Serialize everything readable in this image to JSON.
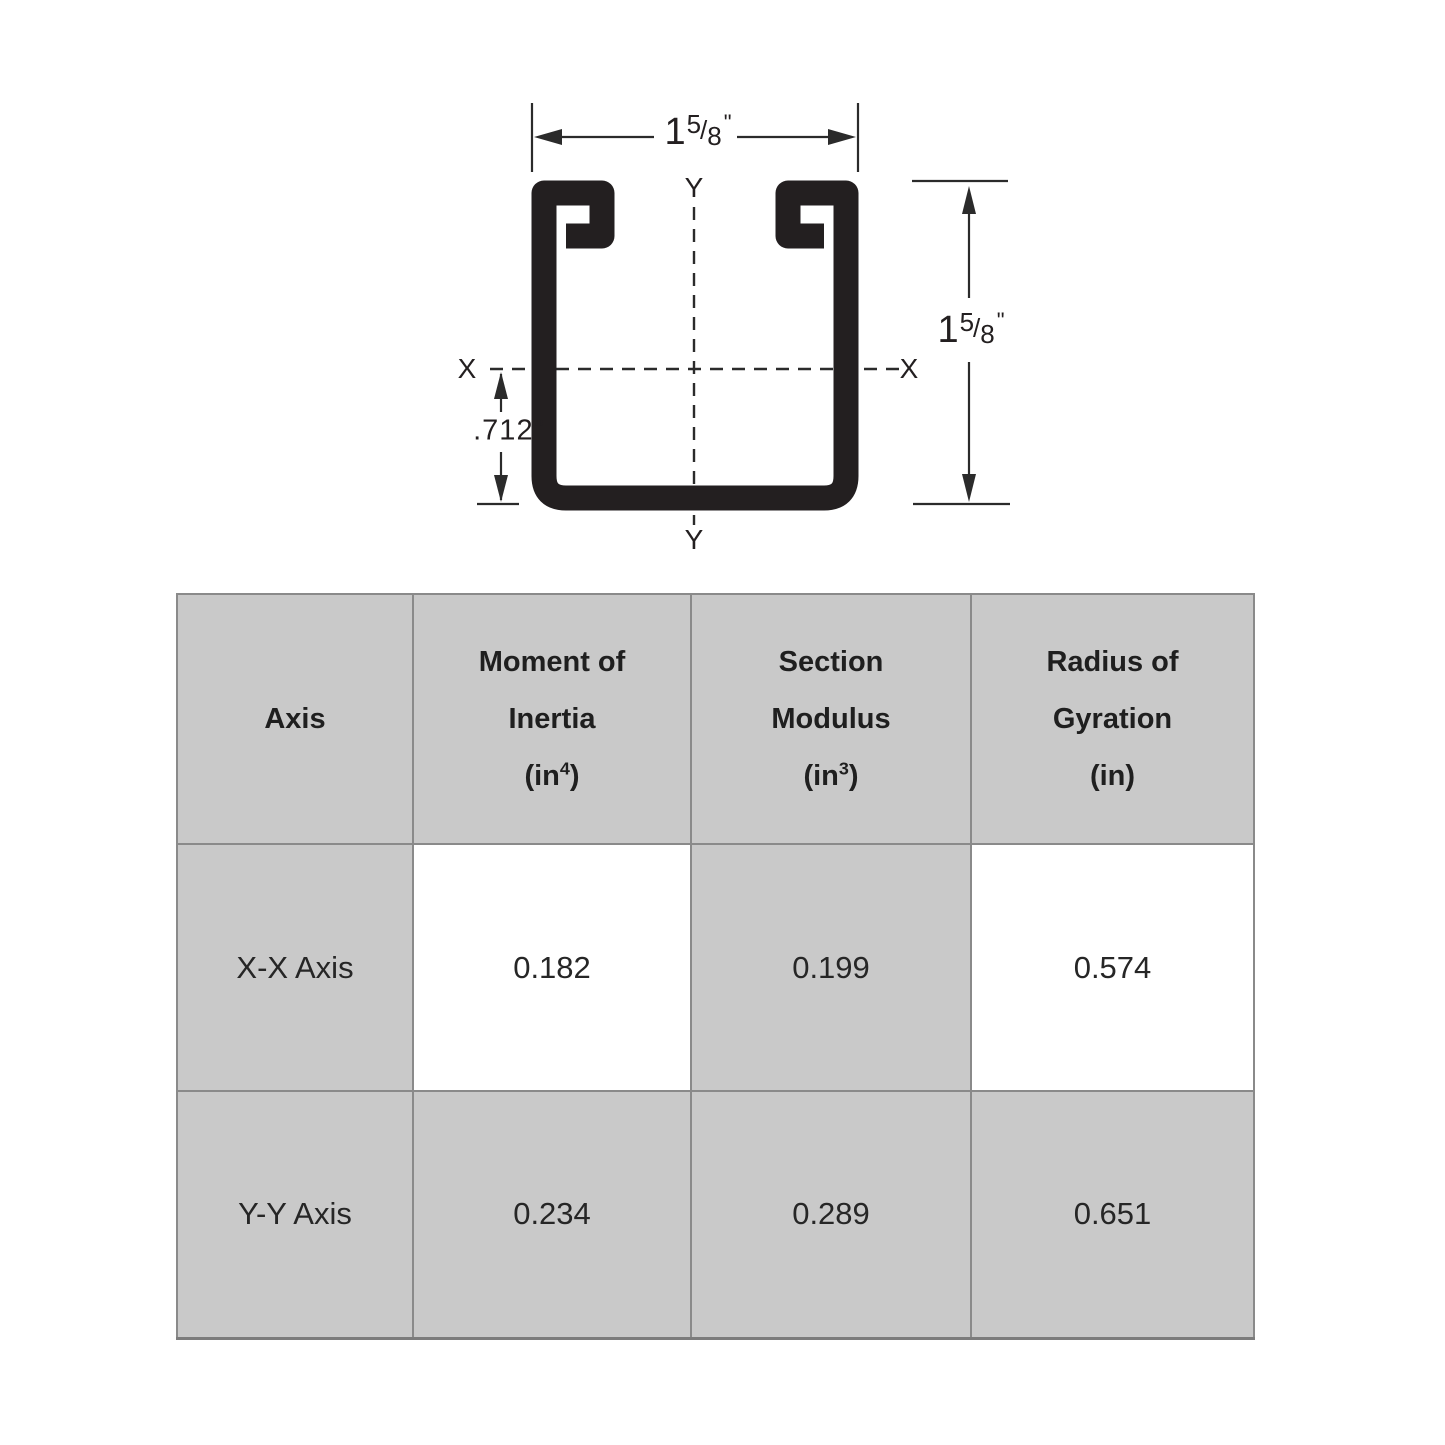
{
  "diagram": {
    "width_dim": {
      "int": "1",
      "num": "5",
      "slash": "/",
      "den": "8",
      "unit": "\""
    },
    "height_dim": {
      "int": "1",
      "num": "5",
      "slash": "/",
      "den": "8",
      "unit": "\""
    },
    "offset_dim": ".712\"",
    "axis_labels": {
      "x_left": "X",
      "x_right": "X",
      "y_top": "Y",
      "y_bottom": "Y"
    }
  },
  "table": {
    "columns": [
      {
        "title1": "Axis",
        "title2": "",
        "unit_open": "",
        "unit_sup": "",
        "unit_close": ""
      },
      {
        "title1": "Moment of",
        "title2": "Inertia",
        "unit_open": "(in",
        "unit_sup": "4",
        "unit_close": ")"
      },
      {
        "title1": "Section",
        "title2": "Modulus",
        "unit_open": "(in",
        "unit_sup": "3",
        "unit_close": ")"
      },
      {
        "title1": "Radius of",
        "title2": "Gyration",
        "unit_open": "(in",
        "unit_sup": "",
        "unit_close": ")"
      }
    ],
    "rows": [
      {
        "axis": "X-X Axis",
        "values": [
          "0.182",
          "0.199",
          "0.574"
        ]
      },
      {
        "axis": "Y-Y Axis",
        "values": [
          "0.234",
          "0.289",
          "0.651"
        ]
      }
    ]
  },
  "colors": {
    "cell_gray": "#c9c9c9",
    "grid_border": "#8a8a8a",
    "ink": "#231f20"
  }
}
